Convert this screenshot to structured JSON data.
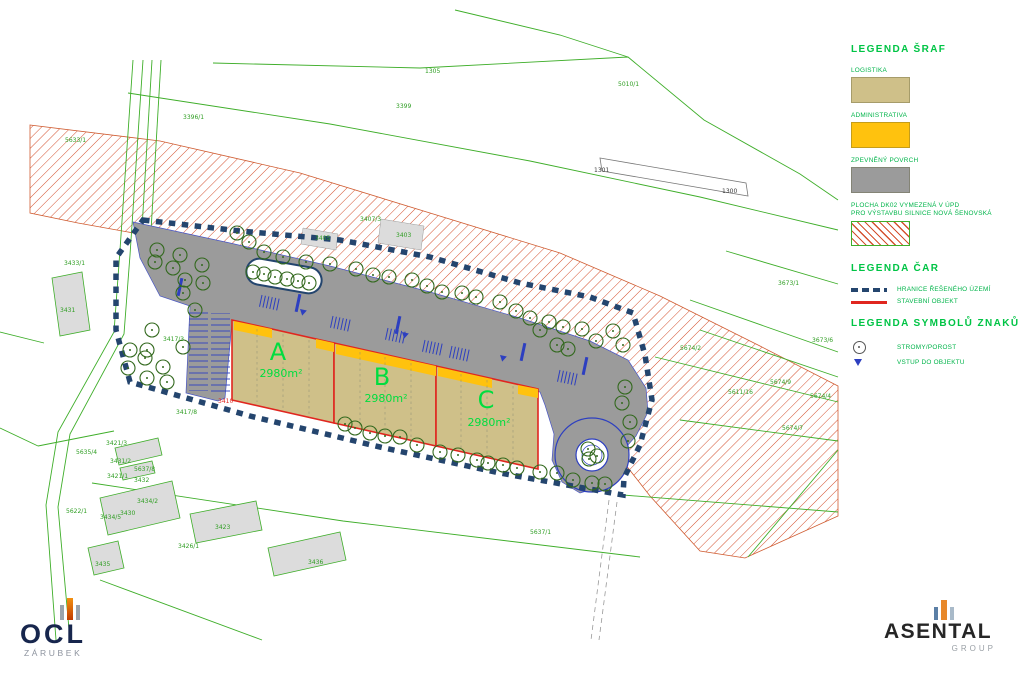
{
  "legend": {
    "hatch_title": "LEGENDA ŠRAF",
    "hatch_items": [
      {
        "label": "LOGISTIKA",
        "color": "#cfc089"
      },
      {
        "label": "ADMINISTRATIVA",
        "color": "#ffc20e"
      },
      {
        "label": "ZPEVNĚNÝ POVRCH",
        "color": "#9b9b9b"
      },
      {
        "label_line1": "PLOCHA DK02 VYMEZENÁ V ÚPD",
        "label_line2": "PRO VÝSTAVBU SILNICE NOVÁ ŠENOVSKÁ",
        "pattern": "red-diagonal-hatch",
        "color": "#d4502e"
      }
    ],
    "lines_title": "LEGENDA ČAR",
    "line_items": [
      {
        "label": "HRANICE ŘEŠENÉHO ÚZEMÍ",
        "style": "blue-dashed",
        "color": "#24456e"
      },
      {
        "label": "STAVEBNÍ OBJEKT",
        "style": "red-solid",
        "color": "#e0261f"
      }
    ],
    "symbols_title": "LEGENDA SYMBOLŮ ZNAKŮ",
    "symbol_items": [
      {
        "label": "STROMY/POROST",
        "icon": "tree-circle-icon"
      },
      {
        "label": "VSTUP DO OBJEKTU",
        "icon": "entrance-triangle-icon",
        "color": "#2d3fc0"
      }
    ]
  },
  "site": {
    "buildings": [
      {
        "name": "A",
        "area": "2980m²"
      },
      {
        "name": "B",
        "area": "2980m²"
      },
      {
        "name": "C",
        "area": "2980m²"
      }
    ]
  },
  "map": {
    "colors": {
      "parcel_line": "#3fae2a",
      "boundary": "#24456e",
      "building_outline": "#e0261f",
      "paved": "#9b9b9b",
      "logistics_fill": "#cfc089",
      "admin_fill": "#ffc20e",
      "hatch_line": "#d4502e",
      "tree": "#33691e",
      "parking_mark": "#2d3fc0"
    },
    "parcel_labels": [
      {
        "t": "1305",
        "x": 425,
        "y": 73
      },
      {
        "t": "3399",
        "x": 396,
        "y": 108
      },
      {
        "t": "3396/1",
        "x": 183,
        "y": 119
      },
      {
        "t": "5633/1",
        "x": 65,
        "y": 142
      },
      {
        "t": "3433/1",
        "x": 64,
        "y": 265
      },
      {
        "t": "3431",
        "x": 60,
        "y": 312
      },
      {
        "t": "5010/1",
        "x": 618,
        "y": 86
      },
      {
        "t": "1301",
        "x": 594,
        "y": 172,
        "c": "black"
      },
      {
        "t": "1300",
        "x": 722,
        "y": 193,
        "c": "black"
      },
      {
        "t": "3407/3",
        "x": 360,
        "y": 221
      },
      {
        "t": "3405",
        "x": 315,
        "y": 240
      },
      {
        "t": "3403",
        "x": 396,
        "y": 237
      },
      {
        "t": "3673/1",
        "x": 778,
        "y": 285
      },
      {
        "t": "3673/6",
        "x": 812,
        "y": 342
      },
      {
        "t": "5674/9",
        "x": 770,
        "y": 384
      },
      {
        "t": "5674/4",
        "x": 810,
        "y": 398
      },
      {
        "t": "5611/16",
        "x": 728,
        "y": 394
      },
      {
        "t": "5674/7",
        "x": 782,
        "y": 430
      },
      {
        "t": "5674/2",
        "x": 680,
        "y": 350
      },
      {
        "t": "3417/3",
        "x": 163,
        "y": 341
      },
      {
        "t": "3417/8",
        "x": 176,
        "y": 414
      },
      {
        "t": "3410",
        "x": 218,
        "y": 403,
        "c": "red"
      },
      {
        "t": "5637/1",
        "x": 530,
        "y": 534
      },
      {
        "t": "3421/3",
        "x": 106,
        "y": 445
      },
      {
        "t": "5635/4",
        "x": 76,
        "y": 454
      },
      {
        "t": "3431/2",
        "x": 110,
        "y": 463
      },
      {
        "t": "5637/8",
        "x": 134,
        "y": 471
      },
      {
        "t": "3421/1",
        "x": 107,
        "y": 478
      },
      {
        "t": "3432",
        "x": 134,
        "y": 482
      },
      {
        "t": "5622/1",
        "x": 66,
        "y": 513
      },
      {
        "t": "3434/2",
        "x": 137,
        "y": 503
      },
      {
        "t": "3430",
        "x": 120,
        "y": 515
      },
      {
        "t": "3434/5",
        "x": 100,
        "y": 519
      },
      {
        "t": "3423",
        "x": 215,
        "y": 529
      },
      {
        "t": "3426/1",
        "x": 178,
        "y": 548
      },
      {
        "t": "3435",
        "x": 95,
        "y": 566
      },
      {
        "t": "3436",
        "x": 308,
        "y": 564
      }
    ],
    "trees": [
      [
        237,
        233
      ],
      [
        249,
        242
      ],
      [
        264,
        252
      ],
      [
        283,
        257
      ],
      [
        306,
        262
      ],
      [
        330,
        264
      ],
      [
        356,
        269
      ],
      [
        373,
        275
      ],
      [
        389,
        277
      ],
      [
        412,
        280
      ],
      [
        427,
        286
      ],
      [
        442,
        292
      ],
      [
        462,
        293
      ],
      [
        476,
        297
      ],
      [
        500,
        302
      ],
      [
        516,
        311
      ],
      [
        530,
        318
      ],
      [
        540,
        330
      ],
      [
        549,
        322
      ],
      [
        563,
        327
      ],
      [
        582,
        329
      ],
      [
        596,
        341
      ],
      [
        613,
        331
      ],
      [
        623,
        345
      ],
      [
        557,
        345
      ],
      [
        568,
        349
      ],
      [
        625,
        387
      ],
      [
        622,
        403
      ],
      [
        630,
        422
      ],
      [
        628,
        441
      ],
      [
        157,
        250
      ],
      [
        180,
        255
      ],
      [
        155,
        262
      ],
      [
        173,
        268
      ],
      [
        185,
        280
      ],
      [
        202,
        265
      ],
      [
        203,
        283
      ],
      [
        183,
        293
      ],
      [
        195,
        310
      ],
      [
        152,
        330
      ],
      [
        147,
        350
      ],
      [
        145,
        358
      ],
      [
        130,
        350
      ],
      [
        128,
        368
      ],
      [
        163,
        367
      ],
      [
        167,
        382
      ],
      [
        147,
        378
      ],
      [
        183,
        347
      ],
      [
        253,
        272
      ],
      [
        264,
        274
      ],
      [
        275,
        277
      ],
      [
        287,
        279
      ],
      [
        298,
        281
      ],
      [
        309,
        283
      ],
      [
        345,
        424
      ],
      [
        355,
        428
      ],
      [
        370,
        433
      ],
      [
        385,
        436
      ],
      [
        400,
        437
      ],
      [
        417,
        445
      ],
      [
        440,
        452
      ],
      [
        458,
        455
      ],
      [
        477,
        460
      ],
      [
        488,
        463
      ],
      [
        503,
        465
      ],
      [
        517,
        468
      ],
      [
        540,
        472
      ],
      [
        557,
        473
      ],
      [
        573,
        480
      ],
      [
        592,
        483
      ],
      [
        605,
        484
      ],
      [
        588,
        449
      ],
      [
        597,
        456
      ],
      [
        589,
        459
      ]
    ]
  },
  "logos": {
    "ocl": {
      "name": "OCL",
      "subtitle": "ZÁRUBEK"
    },
    "asental": {
      "name": "ASENTAL",
      "subtitle": "GROUP"
    }
  }
}
